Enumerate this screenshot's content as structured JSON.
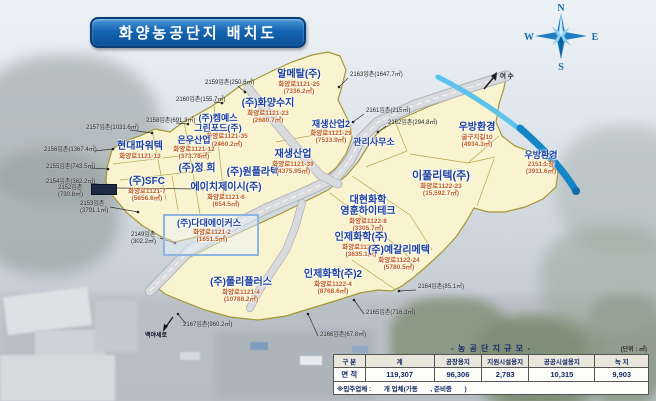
{
  "title": "화양농공단지 배치도",
  "compass": {
    "n": "N",
    "e": "E",
    "s": "S",
    "w": "W"
  },
  "map": {
    "exit_label": "여 수",
    "road_label": "백야세로",
    "parcels": [
      {
        "name": "알메탈(주)",
        "addr": "화양로1121-25",
        "area": "(7336.2㎡)",
        "x": 299,
        "y": 70,
        "size": 10
      },
      {
        "name": "(주)화양수지",
        "addr": "화양로1121-23",
        "area": "(2680.7㎡)",
        "x": 268,
        "y": 99,
        "size": 10
      },
      {
        "name": "(주)켐예스",
        "name2": "그린포드(주)",
        "addr": "화양로1121-35",
        "area": "(2460.2㎡)",
        "x": 218,
        "y": 114,
        "size": 9,
        "ax": 18
      },
      {
        "name": "은우산업",
        "addr": "화양로1121-12",
        "area": "(373.78㎡)",
        "x": 194,
        "y": 136,
        "size": 9
      },
      {
        "name": "현대파워텍",
        "addr": "화양로1121-13",
        "area": "",
        "x": 140,
        "y": 142,
        "size": 10
      },
      {
        "name": "(주)정 희",
        "addr": "",
        "area": "",
        "x": 197,
        "y": 164,
        "size": 10
      },
      {
        "name": "(주)원플라텍",
        "addr": "",
        "area": "",
        "x": 253,
        "y": 168,
        "size": 10
      },
      {
        "name": "재생산업2",
        "addr": "화양로1121-29",
        "area": "(7533.9㎡)",
        "x": 331,
        "y": 120,
        "size": 9
      },
      {
        "name": "재생산업",
        "addr": "화양로1121-39",
        "area": "(4375.95㎡)",
        "x": 293,
        "y": 150,
        "size": 10
      },
      {
        "name": "관리사무소",
        "addr": "",
        "area": "",
        "x": 374,
        "y": 138,
        "size": 9
      },
      {
        "name": "우방환경",
        "addr": "굴구지길10",
        "area": "(4934.3㎡)",
        "x": 477,
        "y": 123,
        "size": 10
      },
      {
        "name": "우방환경",
        "addr": "2151소창",
        "area": "(3911.6㎡)",
        "x": 541,
        "y": 151,
        "size": 9
      },
      {
        "name": "이풀리텍(주)",
        "addr": "화양로1122-23",
        "area": "(15,592.7㎡)",
        "x": 441,
        "y": 171,
        "size": 11
      },
      {
        "name": "대현화학",
        "name2": "영훈하이테크",
        "addr": "화양로1122-8",
        "area": "(3305.7㎡)",
        "x": 368,
        "y": 196,
        "size": 10
      },
      {
        "name": "인제화학(주)",
        "addr": "화양로1122-5",
        "area": "(3635.1㎡)",
        "x": 361,
        "y": 233,
        "size": 10
      },
      {
        "name": "(주)예갈리메텍",
        "addr": "화양로1122-24",
        "area": "(5780.5㎡)",
        "x": 399,
        "y": 246,
        "size": 10
      },
      {
        "name": "인제화학(주)2",
        "addr": "화양로1122-4",
        "area": "(8768.6㎡)",
        "x": 333,
        "y": 270,
        "size": 10
      },
      {
        "name": "(주)폴리플러스",
        "addr": "화양로1121-4",
        "area": "(10788.2㎡)",
        "x": 241,
        "y": 278,
        "size": 10
      },
      {
        "name": "(주)다대에이커스",
        "addr": "화양로1121-2",
        "area": "(1651.5㎡)",
        "x": 209,
        "y": 219,
        "size": 9,
        "ax": 6
      },
      {
        "name": "(주)SFC",
        "addr": "화양로1121-7",
        "area": "(5656.6㎡)",
        "x": 147,
        "y": 177,
        "size": 10
      },
      {
        "name": "에이치제이시(주)",
        "addr": "화양로1121-6",
        "area": "(654.5㎡)",
        "x": 226,
        "y": 183,
        "size": 10
      }
    ],
    "lot_notes": [
      {
        "t": "2159임촌(250.6㎡)",
        "x": 205,
        "y": 80,
        "leader": [
          238,
          86,
          245,
          92
        ]
      },
      {
        "t": "2160임촌(155.7㎡)",
        "x": 176,
        "y": 97,
        "leader": [
          214,
          102,
          222,
          103
        ]
      },
      {
        "t": "2158임촌(691.3㎡)",
        "x": 146,
        "y": 118,
        "leader": [
          176,
          123,
          188,
          124
        ]
      },
      {
        "t": "2157임촌(1031.6㎡)",
        "x": 86,
        "y": 125,
        "leader": [
          130,
          130,
          152,
          133
        ]
      },
      {
        "t": "2156임촌(1367.4㎡)",
        "x": 44,
        "y": 147,
        "leader": [
          94,
          151,
          113,
          149
        ]
      },
      {
        "t": "2155임촌(743.5㎡)",
        "x": 46,
        "y": 164,
        "leader": [
          90,
          168,
          108,
          169
        ]
      },
      {
        "t": "2154임촌(362.2㎡)",
        "x": 46,
        "y": 179,
        "leader": [
          90,
          183,
          109,
          186
        ]
      },
      {
        "t": "2152임촌",
        "t2": "(730.8㎡)",
        "x": 58,
        "y": 185,
        "leader": [
          116,
          188,
          203,
          189
        ],
        "chip": [
          91,
          184,
          24,
          9
        ]
      },
      {
        "t": "2153임촌",
        "t2": "(3791.1㎡)",
        "x": 80,
        "y": 201,
        "leader": [
          110,
          207,
          138,
          212
        ]
      },
      {
        "t": "2149임촌",
        "t2": "(302.2㎡)",
        "x": 131,
        "y": 232,
        "leader": [
          160,
          238,
          175,
          243
        ]
      },
      {
        "t": "2163임촌(1647.7㎡)",
        "x": 350,
        "y": 72,
        "leader": [
          348,
          78,
          339,
          87
        ]
      },
      {
        "t": "2161임촌(215㎡)",
        "x": 366,
        "y": 108,
        "leader": [
          364,
          114,
          353,
          122
        ]
      },
      {
        "t": "2162임촌(294.8㎡)",
        "x": 388,
        "y": 120,
        "leader": [
          386,
          126,
          378,
          132
        ]
      },
      {
        "t": "2164임촌(85.1㎡)",
        "x": 418,
        "y": 284,
        "leader": [
          416,
          290,
          399,
          291
        ]
      },
      {
        "t": "2165임촌(716.3㎡)",
        "x": 366,
        "y": 310,
        "leader": [
          364,
          314,
          354,
          300
        ]
      },
      {
        "t": "2166임촌(67.8㎡)",
        "x": 320,
        "y": 332,
        "leader": [
          318,
          336,
          308,
          314
        ]
      },
      {
        "t": "2167임촌(960.2㎡)",
        "x": 183,
        "y": 322,
        "leader": [
          186,
          324,
          178,
          314
        ]
      }
    ],
    "highlight_box": [
      163,
      214,
      92,
      38
    ]
  },
  "table": {
    "title": "- 농 공 단 지 규 모 -",
    "unit": "(단위 : ㎡)",
    "headers": [
      "구 분",
      "계",
      "공장용지",
      "지원시설용지",
      "공공시설용지",
      "녹 지"
    ],
    "row_label": "면 적",
    "values": [
      "119,307",
      "96,306",
      "2,783",
      "10,315",
      "9,903"
    ],
    "note": "※입주업체 :       개 업체(가동       , 준비중       )"
  }
}
